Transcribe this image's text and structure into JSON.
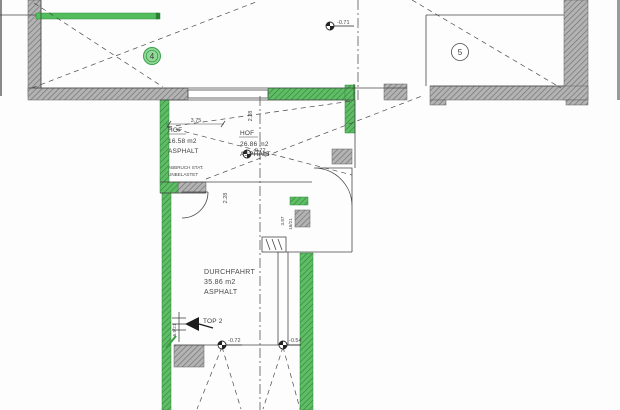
{
  "rooms": {
    "room_4": {
      "number": "4"
    },
    "room_5": {
      "number": "5"
    },
    "hof_left": {
      "name": "HOF",
      "area": "16.58 m2",
      "surface": "ASPHALT"
    },
    "hof_right": {
      "name": "HOF",
      "area": "26.86 m2",
      "surface": "ASPHALT"
    },
    "durchfahrt": {
      "name": "DURCHFAHRT",
      "area": "35.86 m2",
      "surface": "ASPHALT"
    },
    "top_2": {
      "label": "TOP 2"
    }
  },
  "notes": {
    "abbruch": {
      "line1": "ABBRUCH STAT.",
      "line2": "UNBELASTET"
    },
    "stair_left": "6.5/21",
    "stair_right": "16/21"
  },
  "levels": {
    "upper_court": "-0.71",
    "hof": "-0.72",
    "gate_left": "-0.72",
    "gate_right": "-0.54"
  },
  "dimensions": {
    "hof_width": "3.75",
    "top_opening": "2.28",
    "passage_opening": "2.28",
    "niche": "3.87"
  },
  "colors": {
    "highlight_green": "#53bd5d",
    "wall_gray": "#b3b3b3",
    "line": "#3c3c3c"
  }
}
